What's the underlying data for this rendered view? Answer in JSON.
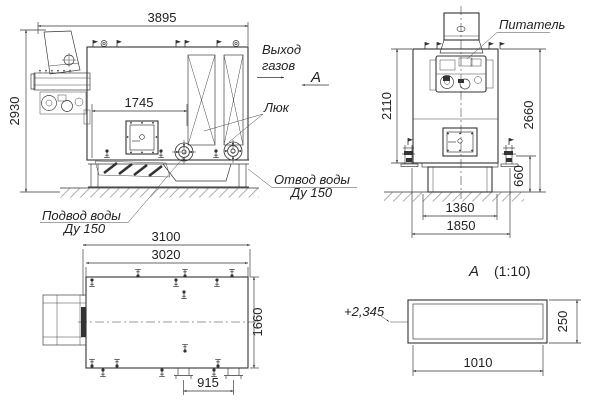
{
  "meta": {
    "bg": "#ffffff",
    "ink": "#333333",
    "hatch": "#9aa0a6"
  },
  "side": {
    "dim_width": "3895",
    "dim_height": "2930",
    "dim_inner": "1745",
    "label_gas_1": "Выход",
    "label_gas_2": "газов",
    "label_section": "А",
    "label_hatch": "Люк",
    "label_outlet_1": "Отвод воды",
    "label_outlet_2": "Ду 150",
    "label_inlet_1": "Подвод воды",
    "label_inlet_2": "Ду 150"
  },
  "front": {
    "label_feeder": "Питатель",
    "dim_body_h": "2110",
    "dim_total_h": "2660",
    "dim_base_h": "660",
    "dim_base_w": "1360",
    "dim_total_w": "1850"
  },
  "top": {
    "dim_total_w": "3100",
    "dim_body_w": "3020",
    "dim_depth": "1660",
    "dim_pipes": "915"
  },
  "detail": {
    "label": "А",
    "scale": "(1:10)",
    "elevation": "+2,345",
    "dim_w": "1010",
    "dim_h": "250"
  }
}
